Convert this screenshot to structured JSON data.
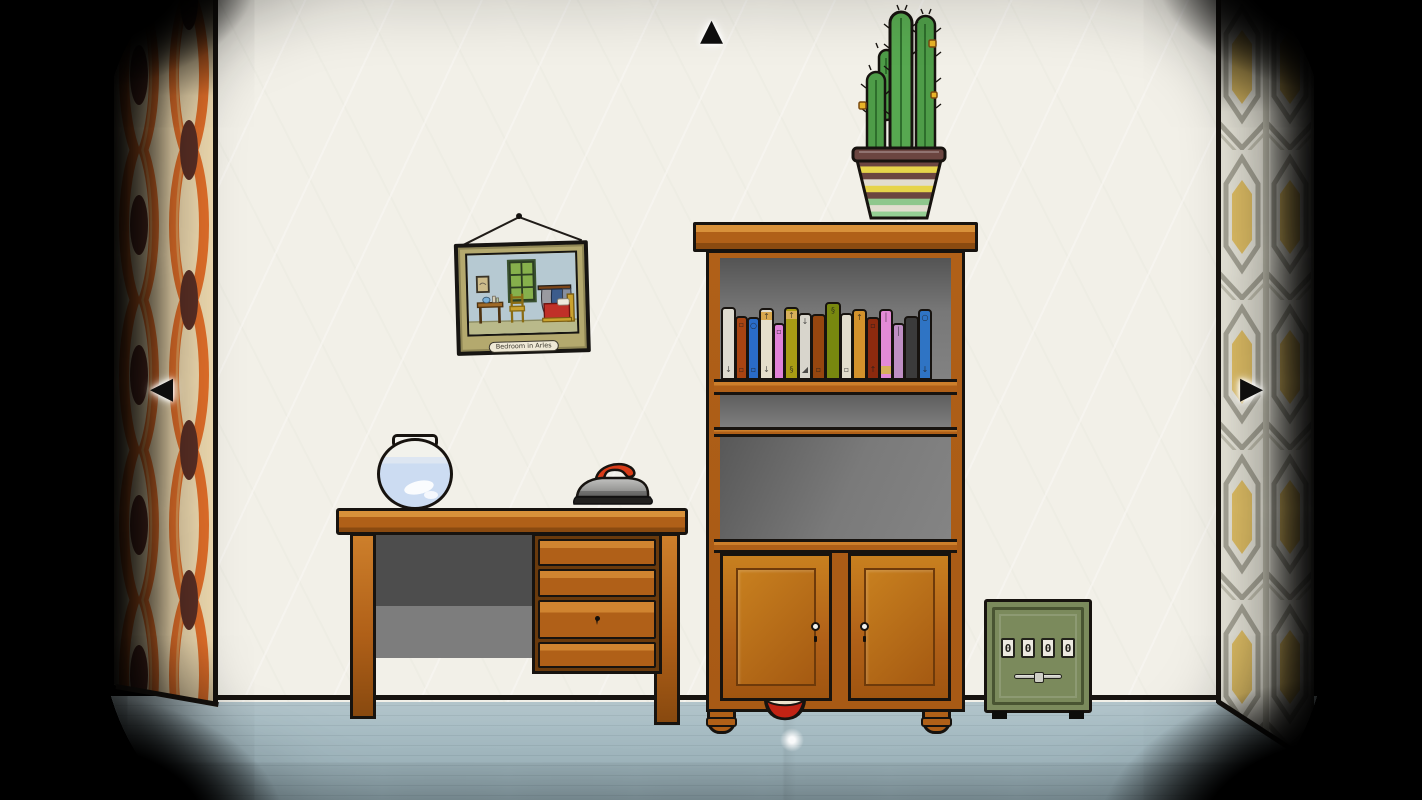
{
  "navigation": {
    "up": "▲",
    "left": "◀",
    "right": "▶"
  },
  "painting": {
    "caption": "Bedroom in Arles"
  },
  "safe": {
    "dials": [
      "0",
      "0",
      "0",
      "0"
    ]
  },
  "bookshelf": {
    "books": [
      {
        "color": "#dedbd0",
        "height": 72,
        "width": 15,
        "symbol_top": "",
        "symbol_bottom": "↓"
      },
      {
        "color": "#a84412",
        "height": 63,
        "width": 13,
        "symbol_top": "▫",
        "symbol_bottom": "▫"
      },
      {
        "color": "#2a6cc8",
        "height": 62,
        "width": 13,
        "symbol_top": "○",
        "symbol_bottom": "▫"
      },
      {
        "color": "#e4decb",
        "height": 71,
        "width": 15,
        "band": "#d8a84e",
        "symbol_top": "↑",
        "symbol_bottom": "↓"
      },
      {
        "color": "#e082d8",
        "height": 56,
        "width": 12,
        "symbol_top": "▫",
        "symbol_bottom": ""
      },
      {
        "color": "#a89c14",
        "height": 72,
        "width": 15,
        "band": "#d8b05a",
        "symbol_top": "↑",
        "symbol_bottom": "§"
      },
      {
        "color": "#d8d5cc",
        "height": 66,
        "width": 14,
        "symbol_top": "↓",
        "symbol_bottom": "◢"
      },
      {
        "color": "#96460f",
        "height": 65,
        "width": 15,
        "symbol_top": "",
        "symbol_bottom": "▫"
      },
      {
        "color": "#78880f",
        "height": 77,
        "width": 16,
        "symbol_top": "§",
        "symbol_bottom": ""
      },
      {
        "color": "#e2ddcc",
        "height": 66,
        "width": 13,
        "symbol_top": "",
        "symbol_bottom": "▫"
      },
      {
        "color": "#d3922c",
        "height": 70,
        "width": 15,
        "symbol_top": "↑",
        "symbol_bottom": ""
      },
      {
        "color": "#8c2a0e",
        "height": 62,
        "width": 14,
        "symbol_top": "▫",
        "symbol_bottom": "↑"
      },
      {
        "color": "#e38ad6",
        "height": 70,
        "width": 14,
        "band": "#d8b05a",
        "band_pos": "bottom",
        "symbol_top": "│",
        "symbol_bottom": ""
      },
      {
        "color": "#bf8fc4",
        "height": 56,
        "width": 13,
        "symbol_top": "│",
        "symbol_bottom": ""
      },
      {
        "color": "#3b3b3b",
        "height": 63,
        "width": 15,
        "symbol_top": "",
        "symbol_bottom": ""
      },
      {
        "color": "#2f74c4",
        "height": 70,
        "width": 14,
        "symbol_top": "○",
        "symbol_bottom": "↓"
      }
    ]
  },
  "cactus_pot": {
    "stripes": [
      "#6b4540",
      "#e6d44a",
      "#6b4540",
      "#e2ddcf",
      "#e6d44a",
      "#6b4540",
      "#8fc78c",
      "#e2ddcf",
      "#95cf94"
    ]
  },
  "colors": {
    "wood": "#b06018",
    "wood-light": "#cd7f2b",
    "wood-dark": "#88490f",
    "wall": "#f2f0e8",
    "floor": "#a9bec5",
    "safe-green": "#7b8a5c",
    "curtain-orange": "#e4702a",
    "curtain-cream": "#f2ddb2",
    "curtain-brown": "#5c3026",
    "paper-bg": "#eceade",
    "paper-line": "#aaa89a",
    "paper-yellow": "#e6c468",
    "cactus-green": "#4e9c48",
    "outline": "#17130f"
  }
}
